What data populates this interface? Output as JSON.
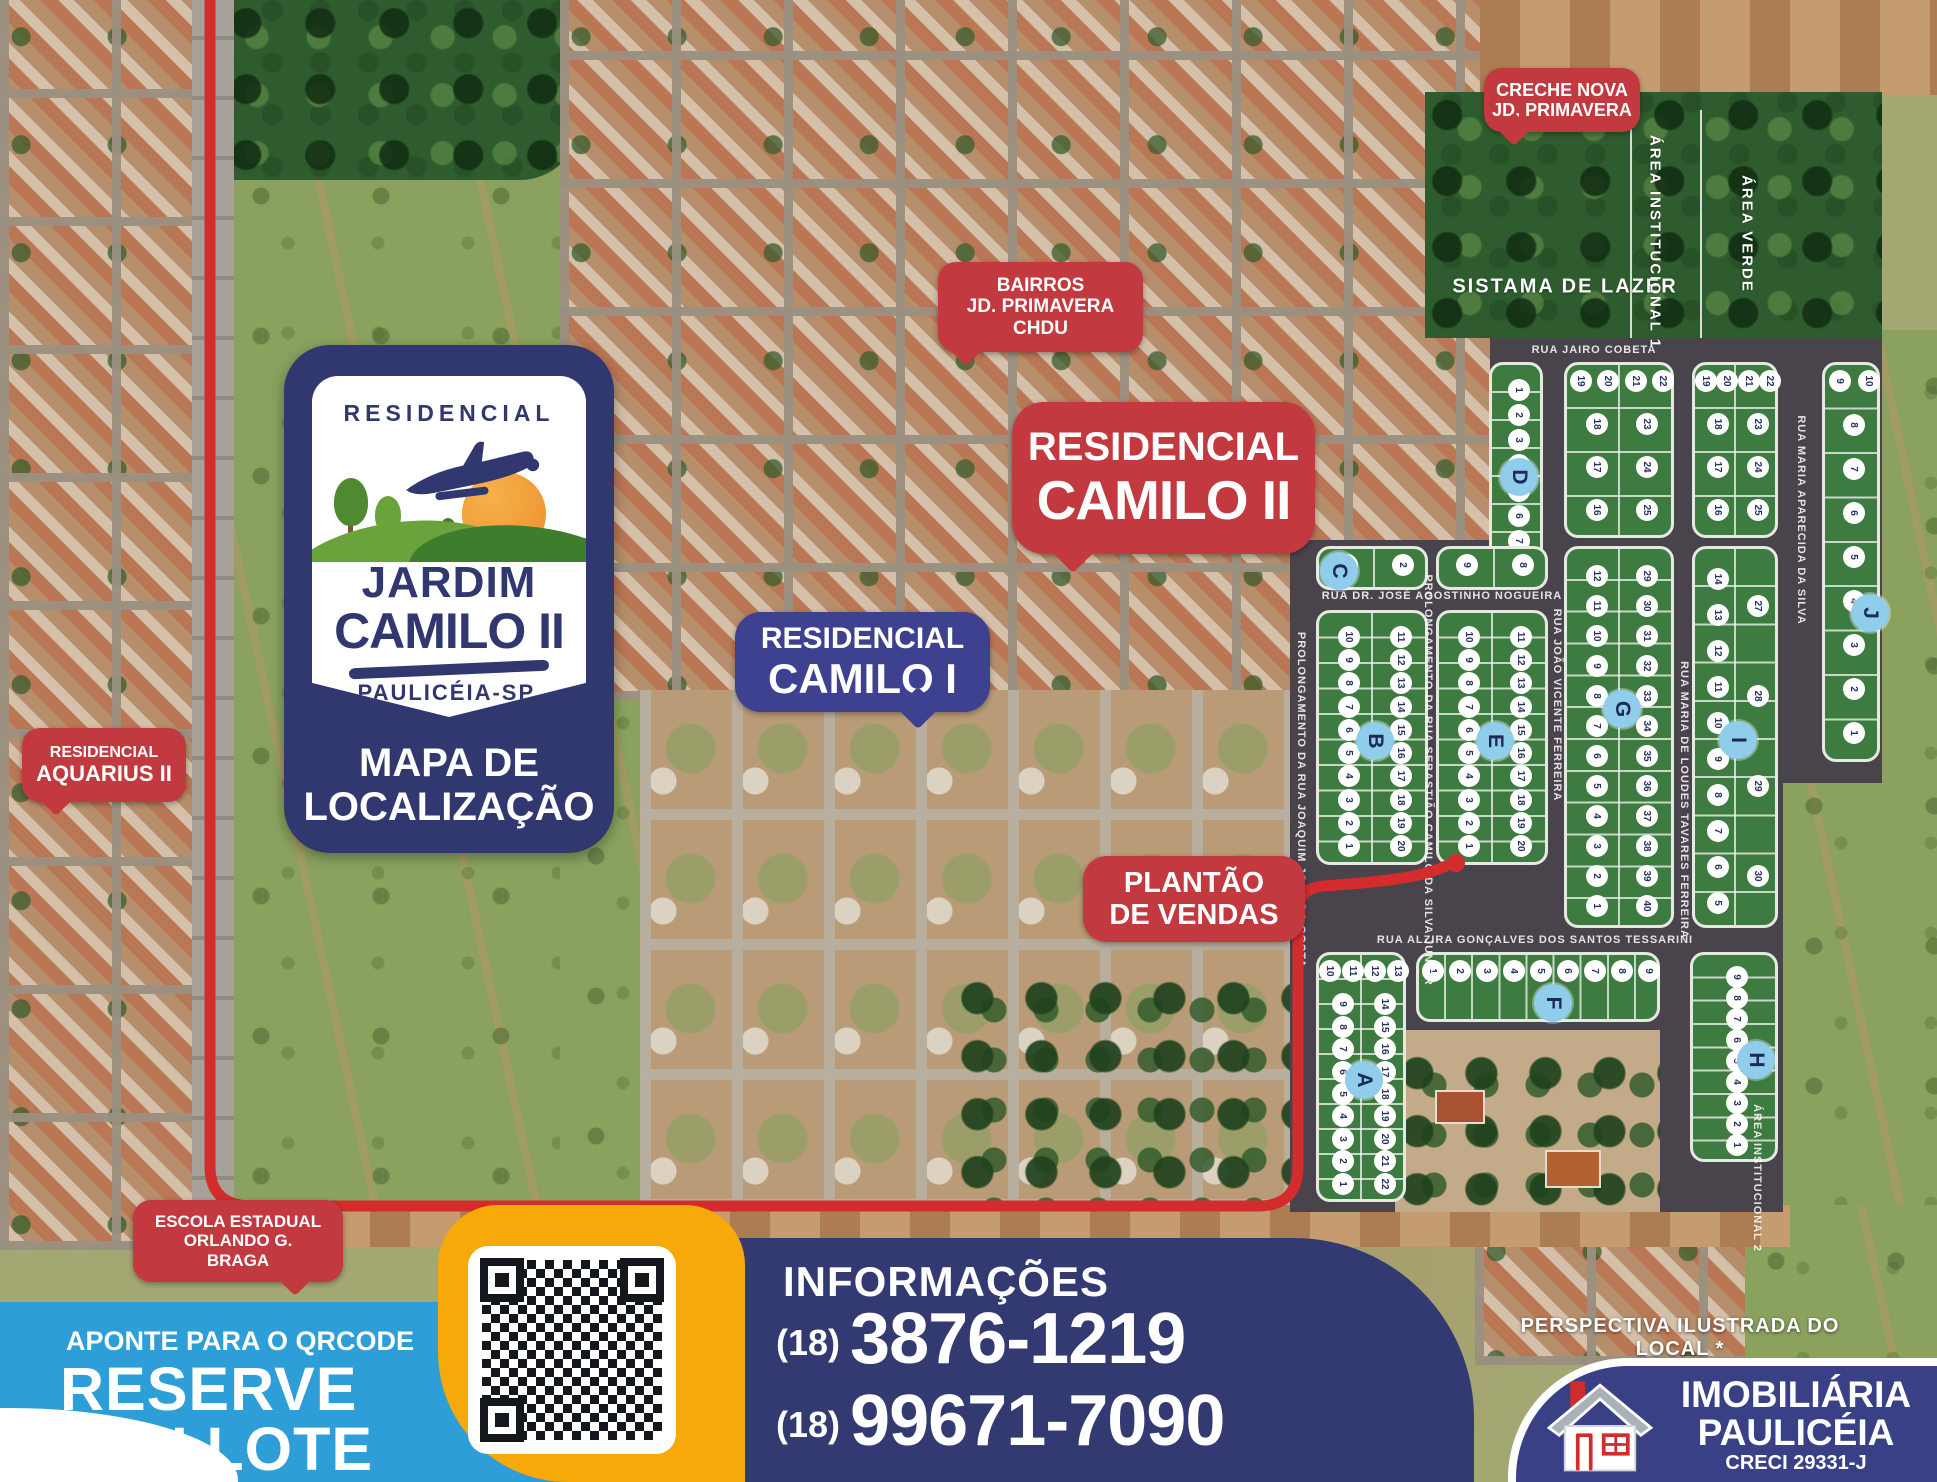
{
  "logo": {
    "kicker": "RESIDENCIAL",
    "name1": "JARDIM",
    "name2": "CAMILO II",
    "city": "PAULICÉIA-SP.",
    "caption1": "MAPA DE",
    "caption2": "LOCALIZAÇÃO"
  },
  "badges": {
    "creche": {
      "line1": "CRECHE NOVA",
      "line2": "JD, PRIMAVERA"
    },
    "bairros": {
      "line1": "BAIRROS",
      "line2": "JD. PRIMAVERA",
      "line3": "CHDU"
    },
    "camilo2": {
      "line1": "RESIDENCIAL",
      "line2": "CAMILO II"
    },
    "camilo1": {
      "line1": "RESIDENCIAL",
      "line2": "CAMILO I"
    },
    "aquarius": {
      "line1": "RESIDENCIAL",
      "line2": "AQUARIUS II"
    },
    "plantao": {
      "line1": "PLANTÃO",
      "line2": "DE VENDAS"
    },
    "escola": {
      "line1": "ESCOLA ESTADUAL",
      "line2": "ORLANDO G.",
      "line3": "BRAGA"
    }
  },
  "map": {
    "area_labels": [
      {
        "name": "SISTAMA DE LAZER",
        "x": 1565,
        "y": 287,
        "v": false,
        "size": 20
      },
      {
        "name": "ÁREA INSTITUCIONAL 1",
        "x": 1655,
        "y": 242,
        "v": true,
        "size": 15
      },
      {
        "name": "ÁREA VERDE",
        "x": 1747,
        "y": 234,
        "v": true,
        "size": 15
      }
    ],
    "streets": [
      {
        "name": "RUA JAIRO COBETA",
        "x": 1594,
        "y": 350,
        "v": false
      },
      {
        "name": "RUA DR. JOSÉ AGOSTINHO NOGUEIRA",
        "x": 1442,
        "y": 596,
        "v": false
      },
      {
        "name": "RUA ALZIRA GONÇALVES DOS SANTOS TESSARINI",
        "x": 1535,
        "y": 940,
        "v": false
      },
      {
        "name": "PROLONGAMENTO DA RUA JOAQUIM JOSÉ DA COSTA",
        "x": 1301,
        "y": 800,
        "v": true
      },
      {
        "name": "PROLONGAMENTO DA RUA SEBASTIÃO CAMILO DA SILVA JUNIOR",
        "x": 1428,
        "y": 780,
        "v": true
      },
      {
        "name": "RUA JOÃO VICENTE FERREIRA",
        "x": 1557,
        "y": 705,
        "v": true
      },
      {
        "name": "RUA MARIA DE LOUDES TAVARES FERREIRA",
        "x": 1684,
        "y": 800,
        "v": true
      },
      {
        "name": "RUA MARIA APARECIDA DA SILVA",
        "x": 1801,
        "y": 520,
        "v": true
      },
      {
        "name": "ÁREA INSTITUCIONAL 2",
        "x": 1757,
        "y": 1178,
        "v": true
      }
    ],
    "blocks": [
      {
        "letter": "D",
        "x": 1489,
        "y": 362,
        "w": 54,
        "h": 224,
        "col": [
          "1",
          "2",
          "3",
          "4",
          "5",
          "6",
          "7",
          "8"
        ]
      },
      {
        "x": 1564,
        "y": 362,
        "w": 110,
        "h": 176,
        "top": [
          "19",
          "20",
          "21",
          "22"
        ],
        "left": [
          "18",
          "17",
          "16"
        ],
        "right": [
          "23",
          "24",
          "25"
        ]
      },
      {
        "x": 1692,
        "y": 362,
        "w": 86,
        "h": 176,
        "top": [
          "19",
          "20",
          "21",
          "22"
        ],
        "left": [
          "18",
          "17",
          "16"
        ],
        "right": [
          "23",
          "24",
          "25"
        ]
      },
      {
        "letter": "J",
        "x": 1822,
        "y": 362,
        "w": 58,
        "h": 400,
        "top": [
          "9",
          "10"
        ],
        "col": [
          "8",
          "7",
          "6",
          "5",
          "4",
          "3",
          "2",
          "1"
        ],
        "lx": 0.78,
        "ly": 0.62
      },
      {
        "letter": "C",
        "x": 1316,
        "y": 546,
        "w": 112,
        "h": 44,
        "top": [
          "1",
          "2"
        ],
        "lx": 0.18,
        "ly": 0.5
      },
      {
        "x": 1436,
        "y": 546,
        "w": 112,
        "h": 44,
        "top": [
          "9",
          "8"
        ]
      },
      {
        "letter": "B",
        "x": 1316,
        "y": 610,
        "w": 112,
        "h": 255,
        "left": [
          "10",
          "9",
          "8",
          "7",
          "6",
          "5",
          "4",
          "3",
          "2",
          "1"
        ],
        "right": [
          "11",
          "12",
          "13",
          "14",
          "15",
          "16",
          "17",
          "18",
          "19",
          "20"
        ]
      },
      {
        "letter": "E",
        "x": 1436,
        "y": 610,
        "w": 112,
        "h": 255,
        "left": [
          "10",
          "9",
          "8",
          "7",
          "6",
          "5",
          "4",
          "3",
          "2",
          "1"
        ],
        "right": [
          "11",
          "12",
          "13",
          "14",
          "15",
          "16",
          "17",
          "18",
          "19",
          "20"
        ]
      },
      {
        "letter": "G",
        "x": 1564,
        "y": 546,
        "w": 110,
        "h": 382,
        "left": [
          "12",
          "11",
          "10",
          "9",
          "8",
          "7",
          "6",
          "5",
          "4",
          "3",
          "2",
          "1"
        ],
        "right": [
          "29",
          "30",
          "31",
          "32",
          "33",
          "34",
          "35",
          "36",
          "37",
          "38",
          "39",
          "40"
        ],
        "ly": 0.42
      },
      {
        "letter": "I",
        "x": 1692,
        "y": 546,
        "w": 86,
        "h": 382,
        "left": [
          "14",
          "13",
          "12",
          "11",
          "10",
          "9",
          "8",
          "7",
          "6",
          "5"
        ],
        "right": [
          "27",
          "28",
          "29",
          "30"
        ],
        "ly": 0.5
      },
      {
        "letter": "A",
        "x": 1316,
        "y": 952,
        "w": 90,
        "h": 250,
        "top": [
          "10",
          "11",
          "12",
          "13"
        ],
        "left": [
          "9",
          "8",
          "7",
          "6",
          "5",
          "4",
          "3",
          "2",
          "1"
        ],
        "right": [
          "14",
          "15",
          "16",
          "17",
          "18",
          "19",
          "20",
          "21",
          "22"
        ]
      },
      {
        "letter": "F",
        "x": 1416,
        "y": 952,
        "w": 244,
        "h": 70,
        "top": [
          "1",
          "2",
          "3",
          "4",
          "5",
          "6",
          "7",
          "8",
          "9"
        ],
        "ly": 0.68,
        "lx": 0.55
      },
      {
        "letter": "H",
        "x": 1690,
        "y": 952,
        "w": 88,
        "h": 210,
        "col": [
          "9",
          "8",
          "7",
          "6",
          "5",
          "4",
          "3",
          "2",
          "1"
        ],
        "lx": 0.72
      }
    ]
  },
  "footer": {
    "qr_hint": "APONTE PARA O QRCODE",
    "reserve1": "RESERVE",
    "reserve2": "SEU LOTE",
    "info_title": "INFORMAÇÕES",
    "phone1_ddd": "(18)",
    "phone1": "3876-1219",
    "phone2_ddd": "(18)",
    "phone2": "99671-7090",
    "perspective": "PERSPECTIVA ILUSTRADA DO LOCAL *",
    "realtor1": "IMOBILIÁRIA",
    "realtor2": "PAULICÉIA",
    "creci": "CRECI 29331-J"
  },
  "colors": {
    "badge_red": "#c23a40",
    "navy": "#31376f",
    "indigo_badge": "#3e4090",
    "route_red": "#d42c2c",
    "ribbon_blue": "#2d9ed8",
    "qr_yellow": "#f6a908",
    "block_green": "#3e7b41",
    "asphalt": "#49434c"
  }
}
